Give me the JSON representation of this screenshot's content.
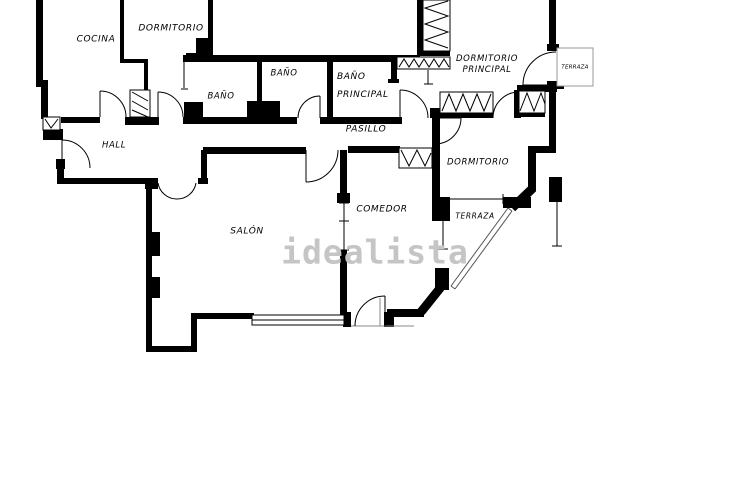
{
  "floorplan": {
    "watermark": "idealista",
    "rooms": {
      "cocina": "COCINA",
      "dormitorio_top": "DORMITORIO",
      "bano_1": "BAÑO",
      "bano_2": "BAÑO",
      "bano_principal": "BAÑO\nPRINCIPAL",
      "dormitorio_principal": "DORMITORIO\nPRINCIPAL",
      "terraza_top": "TERRAZA",
      "hall": "HALL",
      "pasillo": "PASILLO",
      "dormitorio_right": "DORMITORIO",
      "comedor": "COMEDOR",
      "terraza_bottom": "TERRAZA",
      "salon": "SALÓN"
    },
    "colors": {
      "walls": "#000000",
      "background": "#ffffff",
      "watermark": "#c5c5c5",
      "thin_lines": "#555555",
      "terrace_outline": "#999999"
    }
  }
}
